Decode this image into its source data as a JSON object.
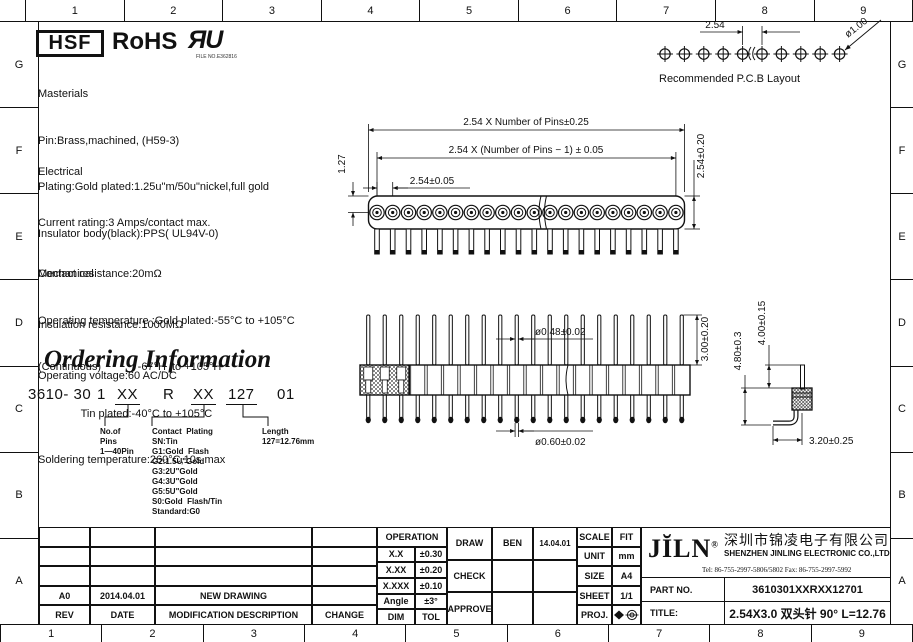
{
  "sheet": {
    "ruler_cols": [
      "1",
      "2",
      "3",
      "4",
      "5",
      "6",
      "7",
      "8",
      "9"
    ],
    "ruler_rows": [
      "G",
      "F",
      "E",
      "D",
      "C",
      "B",
      "A"
    ]
  },
  "header": {
    "hsf": "HSF",
    "rohs": "RoHS",
    "ul_mark": "ЯU",
    "ul_file": "FILE NO.E362816"
  },
  "materials": {
    "title": "Masterials",
    "line1": "Pin:Brass,machined, (H59-3)",
    "line2": "Plating:Gold plated:1.25u\"m/50u\"nickel,full gold",
    "line3": "Insulator body(black):PPS( UL94V-0)"
  },
  "electrical": {
    "title": "Electrical",
    "line1": "Current rating:3 Amps/contact max.",
    "line2": "Contact resistance:20mΩ",
    "line3": "Insulation resistance:1000MΩ",
    "line4": "Operating voltage:60 AC/DC"
  },
  "mechanical": {
    "title": "Mechanical",
    "line1": "Operating temperature :Gold plated:-55°C to +105°C",
    "line2": "(Continuous)            -67°H  to +105°H",
    "line3": "              Tin plated:-40°C to +105°C",
    "line4": "Soldering temperature:260°C,10s max"
  },
  "ordering": {
    "title": "Ordering Information",
    "pn_base": "3610- 30",
    "pn_1": "1",
    "pn_xx1": "XX",
    "pn_r": "R",
    "pn_xx2": "XX",
    "pn_127": "127",
    "pn_01": "01",
    "pins_label": "No.of\nPins\n1—40Pin",
    "plating_label": "Contact  Plating\nSN:Tin\nG1:Gold  Flash\nG2:1.5U\"Gold\nG3:2U\"Gold\nG4:3U\"Gold\nG5:5U\"Gold\nS0:Gold  Flash/Tin\nStandard:G0",
    "length_label": "Length\n127=12.76mm"
  },
  "pcb": {
    "pitch": "2.54",
    "hole": "ø1.00",
    "caption": "Recommended  P.C.B  Layout"
  },
  "top_view": {
    "dim_overall": "2.54  X  Number  of  Pins±0.25",
    "dim_span": "2.54  X  (Number  of  Pins  −  1)  ±  0.05",
    "dim_pitch": "2.54±0.05",
    "dim_offset": "1.27",
    "dim_height": "2.54±0.20"
  },
  "front_view": {
    "dim_pin_top": "ø0.48±0.02",
    "dim_pin_bottom": "ø0.60±0.02",
    "dim_pin_len": "3.00±0.20"
  },
  "side_view": {
    "dim_total": "4.80±0.3",
    "dim_pin": "4.00±0.15",
    "dim_foot": "3.20±0.25"
  },
  "title_block": {
    "operation": {
      "header": "OPERATION",
      "r1c1": "X.X",
      "r1c2": "±0.30",
      "r2c1": "X.XX",
      "r2c2": "±0.20",
      "r3c1": "X.XXX",
      "r3c2": "±0.10",
      "r4c1": "Angle",
      "r4c2": "±3°",
      "r5c1": "DIM",
      "r5c2": "TOL"
    },
    "sign": {
      "draw": "DRAW",
      "draw_name": "BEN",
      "draw_date": "14.04.01",
      "check": "CHECK",
      "approve": "APPROVE"
    },
    "info": {
      "scale": "SCALE",
      "scale_v": "FIT",
      "unit": "UNIT",
      "unit_v": "mm",
      "size": "SIZE",
      "size_v": "A4",
      "sheet": "SHEET",
      "sheet_v": "1/1",
      "proj": "PROJ."
    },
    "company": {
      "logo": "JĬLN",
      "reg": "®",
      "cn": "深圳市锦凌电子有限公司",
      "en": "SHENZHEN JINLING ELECTRONIC CO.,LTD",
      "tel": "Tel: 86-755-2997-5806/5802    Fax: 86-755-2997-5992"
    },
    "part": {
      "label": "PART  NO.",
      "value": "3610301XXRXX12701"
    },
    "title": {
      "label": "TITLE:",
      "value": "2.54X3.0  双头针  90°  L=12.76"
    },
    "revision": {
      "rev": "A0",
      "date": "2014.04.01",
      "desc": "NEW  DRAWING",
      "change": "",
      "h_rev": "REV",
      "h_date": "DATE",
      "h_desc": "MODIFICATION  DESCRIPTION",
      "h_change": "CHANGE"
    }
  }
}
